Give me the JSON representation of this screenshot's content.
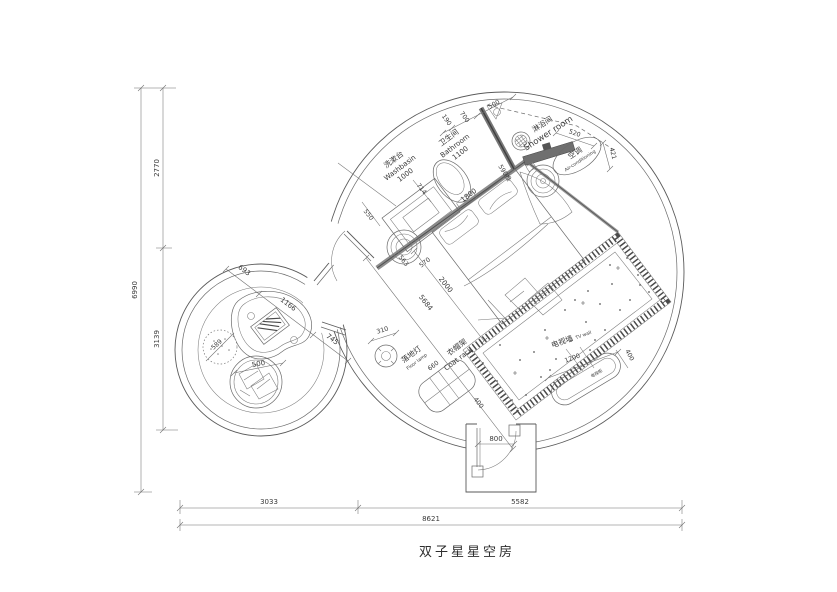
{
  "title": "双子星星空房",
  "dims_left": {
    "total": "6990",
    "top": "2770",
    "bottom": "3139"
  },
  "dims_bottom": {
    "left": "3033",
    "right": "5582",
    "total": "8621"
  },
  "bathroom": {
    "washbasin_zh": "洗漱台",
    "washbasin_en": "Washbasin",
    "washbasin_len": "1000",
    "name_zh": "卫生间",
    "name_en": "Bathroom",
    "width": "1100",
    "d190": "190",
    "d700": "700",
    "d500": "500",
    "door": "590推",
    "toilet_clear": "714",
    "counter_depth": "550"
  },
  "shower": {
    "name_zh": "淋浴间",
    "name_en": "Shower room",
    "screen_len": "520",
    "gap": "421"
  },
  "ac": {
    "name_zh": "空调",
    "name_en": "Air-conditioning"
  },
  "bedroom": {
    "bed_w": "1800",
    "bed_l": "2000",
    "diag": "5684",
    "side_a": "563",
    "side_b": "570",
    "lamp_d": "310",
    "lamp_zh": "落地灯",
    "lamp_en": "Floor lamp",
    "rack_len": "660",
    "rack_zh": "衣帽架",
    "rack_en": "Coat rack",
    "rack_w": "400",
    "tv_zh": "电视墙",
    "tv_en": "TV wall",
    "tv_len": "1200",
    "tv_w": "400",
    "tv_cab": "电视柜"
  },
  "left_room": {
    "d1": "693",
    "d2": "1166",
    "d3": "745",
    "pouf": "589",
    "chair": "500"
  },
  "entrance": {
    "door": "800"
  }
}
